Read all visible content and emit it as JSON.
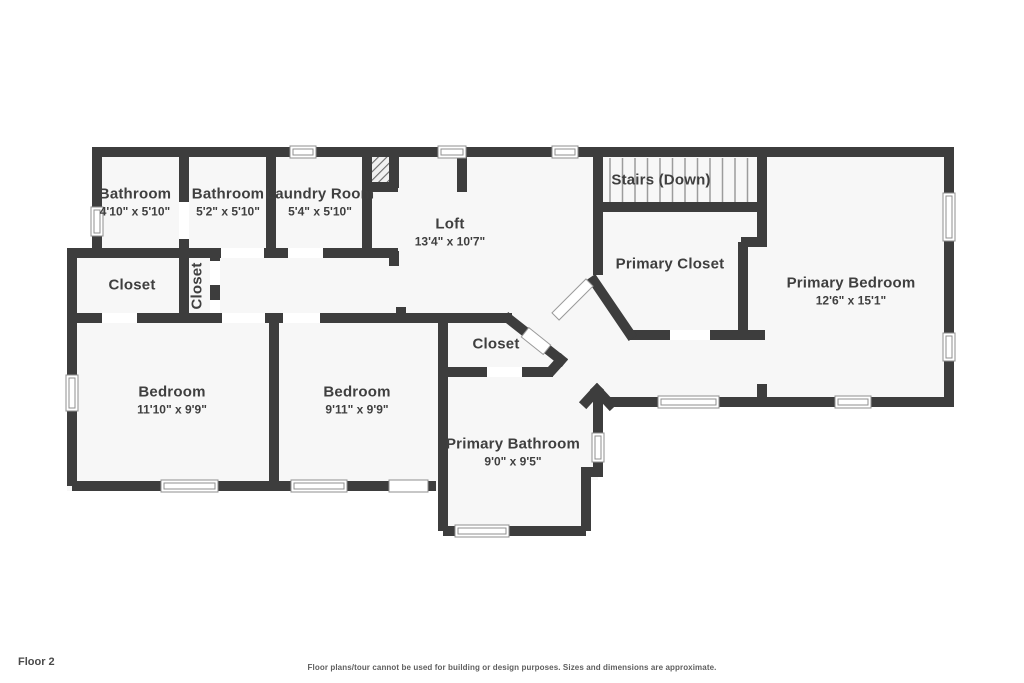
{
  "floor_label": "Floor 2",
  "disclaimer": "Floor plans/tour cannot be used for building or design purposes. Sizes and dimensions are approximate.",
  "colors": {
    "wall": "#3d3d3d",
    "room_fill": "#f7f7f7",
    "label_text": "#3f3f3f",
    "window_frame": "#8f8f8f",
    "stair_tread": "#9c9c9c"
  },
  "rooms": [
    {
      "id": "bathroom-1",
      "name": "Bathroom",
      "dims": "4'10\" x 5'10\""
    },
    {
      "id": "bathroom-2",
      "name": "Bathroom",
      "dims": "5'2\" x 5'10\""
    },
    {
      "id": "laundry-room",
      "name": "Laundry Room",
      "dims": "5'4\" x 5'10\""
    },
    {
      "id": "loft",
      "name": "Loft",
      "dims": "13'4\" x 10'7\""
    },
    {
      "id": "stairs",
      "name": "Stairs (Down)"
    },
    {
      "id": "primary-closet",
      "name": "Primary Closet"
    },
    {
      "id": "primary-bedroom",
      "name": "Primary Bedroom",
      "dims": "12'6\" x 15'1\""
    },
    {
      "id": "closet-left",
      "name": "Closet"
    },
    {
      "id": "closet-hall",
      "name": "Closet"
    },
    {
      "id": "bedroom-1",
      "name": "Bedroom",
      "dims": "11'10\" x 9'9\""
    },
    {
      "id": "bedroom-2",
      "name": "Bedroom",
      "dims": "9'11\" x 9'9\""
    },
    {
      "id": "closet-middle",
      "name": "Closet"
    },
    {
      "id": "primary-bathroom",
      "name": "Primary Bathroom",
      "dims": "9'0\" x 9'5\""
    }
  ]
}
